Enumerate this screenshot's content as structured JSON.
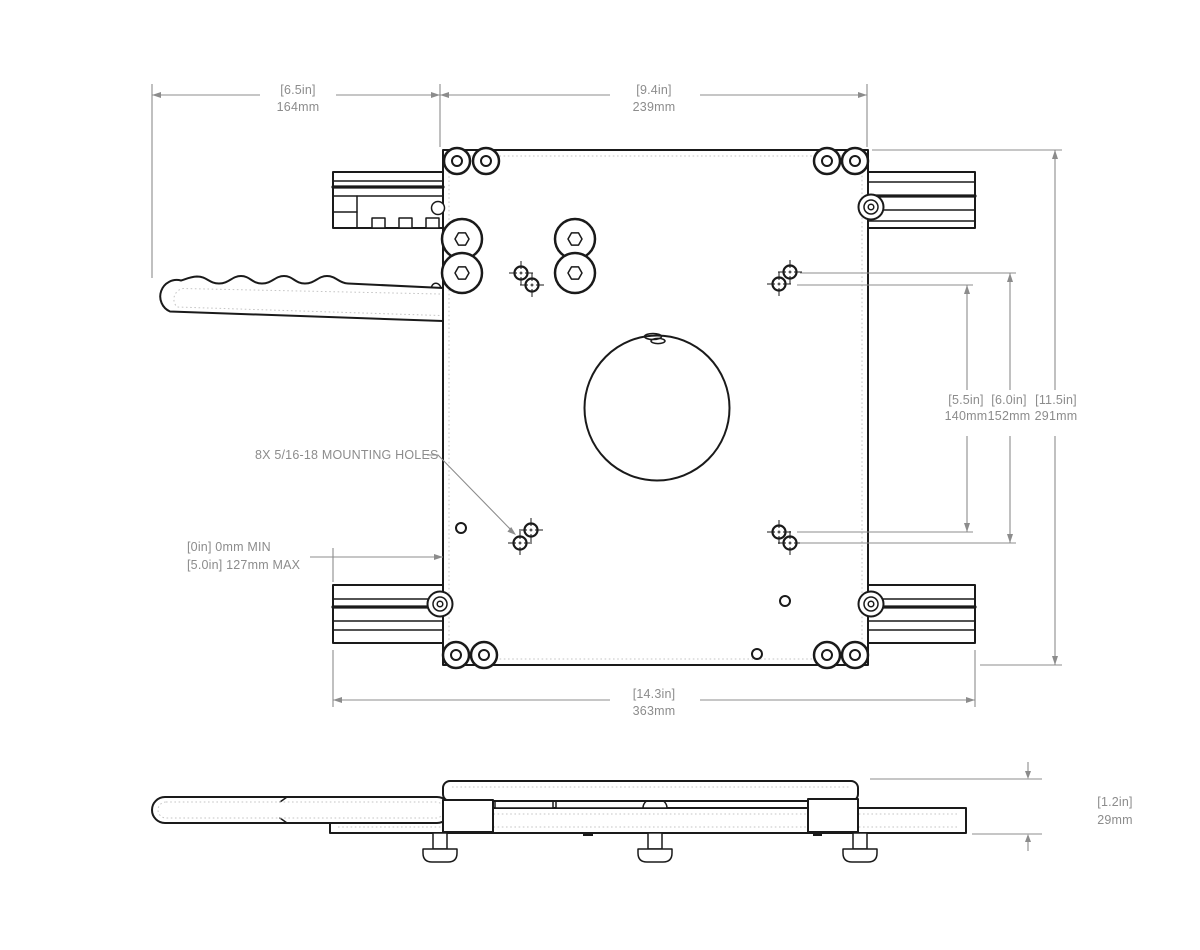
{
  "drawing": {
    "type": "technical-drawing",
    "views": [
      "top-view",
      "side-profile-view"
    ],
    "colors": {
      "line": "#1a1a1a",
      "dimension": "#8c8c8c",
      "hidden_line": "#c5c5c5",
      "background": "#ffffff"
    },
    "dimensions": {
      "handle": {
        "in": "[6.5in]",
        "mm": "164mm"
      },
      "plate_width": {
        "in": "[9.4in]",
        "mm": "239mm"
      },
      "hole_span_inner": {
        "in": "[5.5in]",
        "mm": "140mm"
      },
      "hole_span_outer": {
        "in": "[6.0in]",
        "mm": "152mm"
      },
      "plate_height": {
        "in": "[11.5in]",
        "mm": "291mm"
      },
      "overall_width": {
        "in": "[14.3in]",
        "mm": "363mm"
      },
      "profile_height": {
        "in": "[1.2in]",
        "mm": "29mm"
      },
      "travel": {
        "min": "[0in] 0mm MIN",
        "max": "[5.0in] 127mm MAX"
      }
    },
    "callouts": {
      "mounting_holes": "8X 5/16-18 MOUNTING HOLES"
    }
  }
}
